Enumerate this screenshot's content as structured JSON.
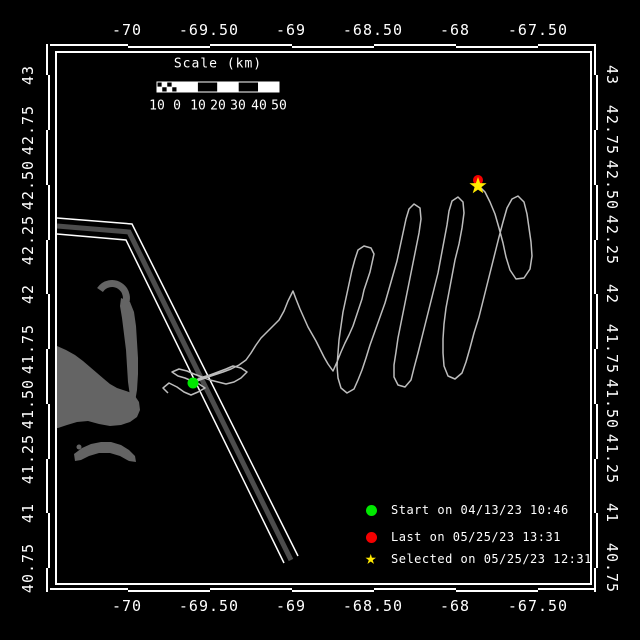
{
  "window": {
    "width": 640,
    "height": 640,
    "background": "#000000"
  },
  "axes": {
    "top": {
      "labels": [
        "-70",
        "-69.50",
        "-69",
        "-68.50",
        "-68",
        "-67.50"
      ],
      "x_px": [
        127,
        209,
        291,
        373,
        455,
        538
      ],
      "y_px": 30
    },
    "bottom": {
      "labels": [
        "-70",
        "-69.50",
        "-69",
        "-68.50",
        "-68",
        "-67.50"
      ],
      "x_px": [
        127,
        209,
        291,
        373,
        455,
        538
      ],
      "y_px": 606
    },
    "left": {
      "labels": [
        "43",
        "42.75",
        "42.50",
        "42.25",
        "42",
        "41.75",
        "41.50",
        "41.25",
        "41",
        "40.75"
      ],
      "y_px": [
        75,
        130,
        185,
        240,
        294,
        349,
        404,
        459,
        513,
        568
      ],
      "x_px": 28
    },
    "right": {
      "labels": [
        "43",
        "42.75",
        "42.50",
        "42.25",
        "42",
        "41.75",
        "41.50",
        "41.25",
        "41",
        "40.75"
      ],
      "y_px": [
        75,
        130,
        185,
        240,
        294,
        349,
        404,
        459,
        513,
        568
      ],
      "x_px": 612
    },
    "lon_range": [
      -70.43,
      -67.18
    ],
    "lat_range": [
      40.83,
      43.02
    ]
  },
  "frame": {
    "color": "#ffffff",
    "inner": {
      "x": 56,
      "y": 52,
      "w": 535,
      "h": 532
    },
    "h_bounds": [
      46,
      128,
      210,
      292,
      374,
      456,
      538,
      598
    ],
    "v_bounds": [
      44,
      75,
      130,
      185,
      240,
      294,
      349,
      404,
      459,
      513,
      568,
      592
    ],
    "band_colors": [
      "#ffffff",
      "#000000"
    ]
  },
  "scalebar": {
    "title": "Scale (km)",
    "title_x": 218,
    "title_y": 64,
    "labels": [
      "10",
      "0",
      "10",
      "20",
      "30",
      "40",
      "50"
    ],
    "label_x_px": [
      157,
      177,
      198,
      218,
      238,
      259,
      279
    ],
    "labels_y": 106,
    "bar": {
      "x": 157,
      "y": 82,
      "w": 122,
      "h": 10
    }
  },
  "legend": {
    "items": [
      {
        "symbol": "circle",
        "glyph": "",
        "color": "#00e800",
        "label": "Start on 04/13/23 10:46"
      },
      {
        "symbol": "circle",
        "glyph": "",
        "color": "#f40000",
        "label": "Last on 05/25/23 13:31"
      },
      {
        "symbol": "star",
        "glyph": "★",
        "color": "#ffe900",
        "label": "Selected on 05/25/23 12:31"
      }
    ]
  },
  "markers": {
    "start": {
      "x": 193,
      "y": 383,
      "color": "#00e800",
      "lon": -69.6,
      "lat": 41.6
    },
    "last": {
      "x": 478,
      "y": 180,
      "color": "#f40000",
      "lon": -67.87,
      "lat": 42.52
    },
    "selected": {
      "x": 478,
      "y": 186,
      "color": "#ffe900",
      "lon": -67.87,
      "lat": 42.5
    }
  },
  "track": {
    "color": "#bdbdbd",
    "points": [
      [
        168,
        393
      ],
      [
        163,
        388
      ],
      [
        169,
        383
      ],
      [
        177,
        387
      ],
      [
        184,
        392
      ],
      [
        191,
        395
      ],
      [
        198,
        392
      ],
      [
        205,
        388
      ],
      [
        199,
        384
      ],
      [
        192,
        381
      ],
      [
        185,
        378
      ],
      [
        178,
        376
      ],
      [
        172,
        372
      ],
      [
        179,
        369
      ],
      [
        187,
        371
      ],
      [
        194,
        374
      ],
      [
        202,
        377
      ],
      [
        210,
        380
      ],
      [
        218,
        382
      ],
      [
        226,
        384
      ],
      [
        234,
        382
      ],
      [
        241,
        378
      ],
      [
        247,
        372
      ],
      [
        241,
        368
      ],
      [
        233,
        366
      ],
      [
        226,
        369
      ],
      [
        218,
        372
      ],
      [
        210,
        375
      ],
      [
        203,
        377
      ],
      [
        196,
        380
      ],
      [
        190,
        383
      ],
      [
        197,
        381
      ],
      [
        205,
        378
      ],
      [
        214,
        375
      ],
      [
        223,
        372
      ],
      [
        231,
        369
      ],
      [
        239,
        365
      ],
      [
        246,
        360
      ],
      [
        251,
        353
      ],
      [
        256,
        345
      ],
      [
        261,
        338
      ],
      [
        267,
        332
      ],
      [
        273,
        326
      ],
      [
        279,
        320
      ],
      [
        284,
        311
      ],
      [
        288,
        301
      ],
      [
        293,
        291
      ],
      [
        296,
        299
      ],
      [
        300,
        309
      ],
      [
        304,
        318
      ],
      [
        308,
        327
      ],
      [
        312,
        334
      ],
      [
        316,
        341
      ],
      [
        320,
        349
      ],
      [
        324,
        357
      ],
      [
        328,
        364
      ],
      [
        333,
        371
      ],
      [
        337,
        362
      ],
      [
        341,
        352
      ],
      [
        345,
        343
      ],
      [
        349,
        335
      ],
      [
        353,
        326
      ],
      [
        356,
        317
      ],
      [
        359,
        308
      ],
      [
        362,
        299
      ],
      [
        364,
        290
      ],
      [
        367,
        281
      ],
      [
        370,
        272
      ],
      [
        372,
        263
      ],
      [
        374,
        254
      ],
      [
        371,
        248
      ],
      [
        364,
        246
      ],
      [
        358,
        250
      ],
      [
        355,
        259
      ],
      [
        352,
        270
      ],
      [
        349,
        284
      ],
      [
        346,
        298
      ],
      [
        343,
        312
      ],
      [
        341,
        326
      ],
      [
        339,
        340
      ],
      [
        338,
        353
      ],
      [
        337,
        366
      ],
      [
        338,
        378
      ],
      [
        341,
        388
      ],
      [
        347,
        393
      ],
      [
        354,
        389
      ],
      [
        358,
        380
      ],
      [
        362,
        370
      ],
      [
        366,
        358
      ],
      [
        370,
        345
      ],
      [
        375,
        331
      ],
      [
        380,
        317
      ],
      [
        385,
        303
      ],
      [
        389,
        289
      ],
      [
        393,
        275
      ],
      [
        397,
        261
      ],
      [
        400,
        247
      ],
      [
        403,
        233
      ],
      [
        406,
        219
      ],
      [
        409,
        209
      ],
      [
        414,
        204
      ],
      [
        420,
        208
      ],
      [
        421,
        219
      ],
      [
        419,
        233
      ],
      [
        416,
        248
      ],
      [
        413,
        263
      ],
      [
        410,
        278
      ],
      [
        407,
        293
      ],
      [
        404,
        308
      ],
      [
        401,
        323
      ],
      [
        398,
        338
      ],
      [
        396,
        352
      ],
      [
        394,
        365
      ],
      [
        394,
        377
      ],
      [
        398,
        385
      ],
      [
        405,
        387
      ],
      [
        411,
        380
      ],
      [
        414,
        368
      ],
      [
        418,
        353
      ],
      [
        422,
        337
      ],
      [
        426,
        321
      ],
      [
        430,
        305
      ],
      [
        434,
        289
      ],
      [
        438,
        273
      ],
      [
        441,
        257
      ],
      [
        444,
        241
      ],
      [
        447,
        225
      ],
      [
        449,
        211
      ],
      [
        452,
        201
      ],
      [
        458,
        197
      ],
      [
        463,
        202
      ],
      [
        464,
        213
      ],
      [
        462,
        228
      ],
      [
        459,
        244
      ],
      [
        455,
        260
      ],
      [
        452,
        276
      ],
      [
        449,
        292
      ],
      [
        446,
        308
      ],
      [
        444,
        324
      ],
      [
        443,
        339
      ],
      [
        443,
        353
      ],
      [
        444,
        366
      ],
      [
        448,
        376
      ],
      [
        455,
        379
      ],
      [
        462,
        373
      ],
      [
        466,
        362
      ],
      [
        470,
        348
      ],
      [
        474,
        333
      ],
      [
        479,
        317
      ],
      [
        483,
        301
      ],
      [
        487,
        285
      ],
      [
        491,
        269
      ],
      [
        495,
        253
      ],
      [
        499,
        237
      ],
      [
        503,
        222
      ],
      [
        507,
        208
      ],
      [
        512,
        199
      ],
      [
        518,
        196
      ],
      [
        524,
        202
      ],
      [
        527,
        214
      ],
      [
        529,
        228
      ],
      [
        531,
        242
      ],
      [
        532,
        256
      ],
      [
        530,
        269
      ],
      [
        524,
        278
      ],
      [
        516,
        279
      ],
      [
        510,
        270
      ],
      [
        506,
        257
      ],
      [
        503,
        243
      ],
      [
        499,
        228
      ],
      [
        495,
        214
      ],
      [
        490,
        202
      ],
      [
        485,
        192
      ],
      [
        480,
        187
      ]
    ]
  },
  "lane": {
    "fill": "#4c4c4c",
    "edge": "#ffffff",
    "band": [
      [
        57,
        226
      ],
      [
        129,
        232
      ],
      [
        291,
        560
      ]
    ],
    "edge1": [
      [
        57,
        218
      ],
      [
        132,
        224
      ],
      [
        298,
        556
      ]
    ],
    "edge2": [
      [
        57,
        234
      ],
      [
        126,
        240
      ],
      [
        284,
        563
      ]
    ]
  },
  "land": {
    "color": "#646464",
    "cape_body": [
      [
        57,
        346
      ],
      [
        66,
        350
      ],
      [
        75,
        355
      ],
      [
        83,
        361
      ],
      [
        90,
        367
      ],
      [
        97,
        373
      ],
      [
        104,
        379
      ],
      [
        110,
        384
      ],
      [
        117,
        388
      ],
      [
        123,
        390
      ],
      [
        129,
        392
      ],
      [
        135,
        396
      ],
      [
        139,
        402
      ],
      [
        140,
        410
      ],
      [
        137,
        417
      ],
      [
        130,
        422
      ],
      [
        121,
        425
      ],
      [
        110,
        426
      ],
      [
        99,
        424
      ],
      [
        88,
        421
      ],
      [
        77,
        422
      ],
      [
        67,
        425
      ],
      [
        58,
        428
      ],
      [
        57,
        428
      ]
    ],
    "cape_arm": [
      [
        121,
        298
      ],
      [
        130,
        302
      ],
      [
        134,
        312
      ],
      [
        136,
        326
      ],
      [
        137,
        342
      ],
      [
        138,
        358
      ],
      [
        138,
        374
      ],
      [
        137,
        390
      ],
      [
        135,
        402
      ],
      [
        130,
        396
      ],
      [
        128,
        382
      ],
      [
        127,
        366
      ],
      [
        126,
        350
      ],
      [
        124,
        334
      ],
      [
        122,
        318
      ],
      [
        120,
        306
      ]
    ],
    "hook_arc": "M 124,306 A 13,13 0 1 0 100,290",
    "nantucket": [
      [
        74,
        454
      ],
      [
        82,
        448
      ],
      [
        91,
        444
      ],
      [
        101,
        442
      ],
      [
        111,
        442
      ],
      [
        121,
        445
      ],
      [
        129,
        450
      ],
      [
        135,
        456
      ],
      [
        136,
        462
      ],
      [
        129,
        461
      ],
      [
        120,
        456
      ],
      [
        110,
        453
      ],
      [
        99,
        453
      ],
      [
        89,
        456
      ],
      [
        81,
        460
      ],
      [
        75,
        461
      ]
    ],
    "islet": {
      "cx": 79,
      "cy": 447,
      "r": 2.5
    }
  }
}
